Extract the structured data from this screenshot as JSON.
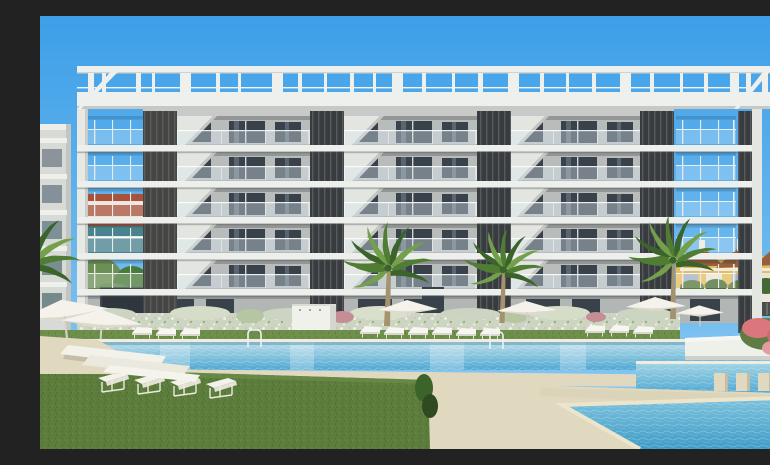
{
  "scene": {
    "type": "architectural-render-photo",
    "description": "New-build modern white apartment block, 5 balcony floors plus rooftop pergola, dark louvered pillar accents, fronted by a landscaped pool area with palm trees, white sun loungers, parasols, lawn and a second pool with stepping stones",
    "sky": "clear blue, sunny",
    "objects": [
      "rooftop pergola frame",
      "apartment facade with glass balconies",
      "dark louvered pillars",
      "white floor slabs",
      "ground-floor terraces",
      "flowering white hedge",
      "three tall palm trees",
      "foreground palm fronds",
      "main swimming pool",
      "pool ladders",
      "white parasols",
      "rows of white sun loungers",
      "white outdoor shower wall",
      "raised white planter",
      "pink flowering bush",
      "second pool with stepping stones",
      "kids pool triangle",
      "green lawn",
      "beige sun deck",
      "neighbouring white building left",
      "colourful background buildings left",
      "yellow townhouses with brown roofs right"
    ]
  },
  "colors": {
    "sky_top": "#3d9fe8",
    "sky_bottom": "#90ccf3",
    "facade": "#c7cac9",
    "facade_recess": "#b8bcbb",
    "slab": "#edefec",
    "pillar": "#393c3f",
    "pillar_stripe": "#565b5e",
    "window": "#39414b",
    "pergola": "#eef0ed",
    "hedge": "#ccd5c1",
    "grass": "#5d7d3d",
    "grass_dark": "#4c6c30",
    "sand": "#e0d9bf",
    "sand_dark": "#d2cab0",
    "white": "#f4f3ee",
    "water_light": "#b9dde9",
    "water_deep": "#4ea8d2",
    "water_kid": "#3f9cc8",
    "house_yellow": "#e3bd5f",
    "house_roof": "#96603c",
    "bg_red": "#a8523c",
    "bg_teal": "#49838e",
    "palm_trunk": "#a5926e",
    "palm_green": "#4f7d33",
    "palm_green_light": "#74a04b",
    "palm_green_dark": "#3c642a",
    "flower_pink": "#d9777c",
    "leaf": "#6c8f55",
    "fence_dark": "#4a4f49",
    "mat_brown": "#ab9468"
  }
}
